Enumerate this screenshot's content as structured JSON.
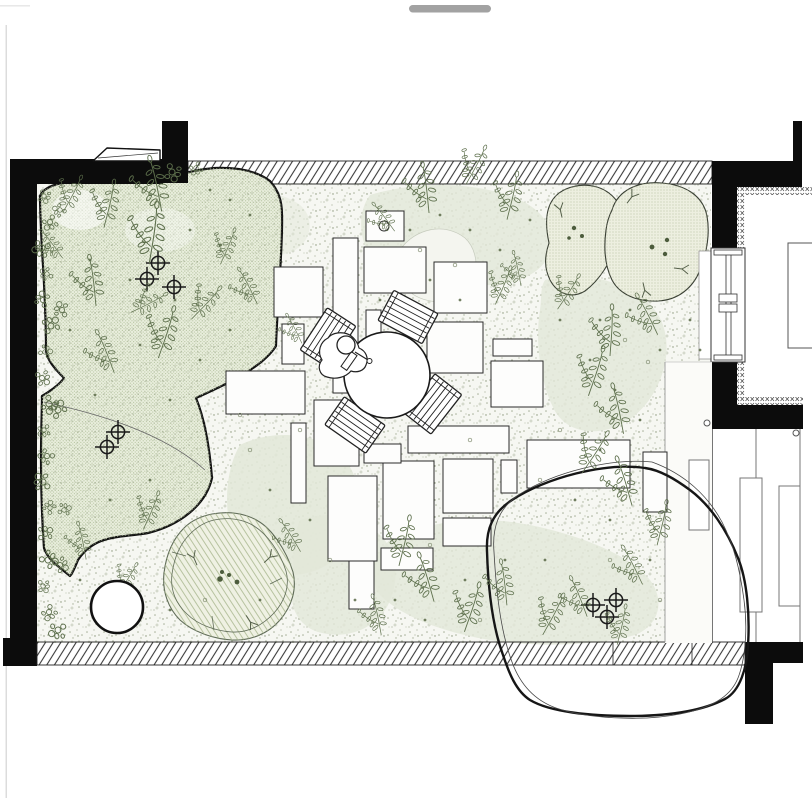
{
  "canvas": {
    "width": 812,
    "height": 800,
    "background": "#ffffff"
  },
  "ui": {
    "drag_handle": {
      "color": "#a2a2a2"
    }
  },
  "palette": {
    "ink": "#1a1a1a",
    "wall_black": "#0c0c0c",
    "line_gray": "#555555",
    "foliage_green": "#5d6f4c",
    "twig_green": "#55604a",
    "bed_base": "#e9eedd",
    "bed_dot": "#b0bf99",
    "mound_base": "#edefe0",
    "mound_dot": "#a8b192",
    "groundcover_base": "#eff1e3",
    "groundcover_line": "#a9b78f",
    "wash_green": "#e2e7d8",
    "stipple": "#97a287",
    "marker_dot": "#4c5c3c"
  },
  "plan": {
    "paving_stones": [
      [
        366,
        211,
        38,
        30,
        1
      ],
      [
        333,
        238,
        25,
        155,
        0
      ],
      [
        364,
        247,
        62,
        46,
        0
      ],
      [
        434,
        262,
        53,
        51,
        0
      ],
      [
        274,
        267,
        49,
        50,
        0
      ],
      [
        282,
        324,
        22,
        40,
        0
      ],
      [
        366,
        310,
        15,
        84,
        0
      ],
      [
        427,
        322,
        56,
        51,
        0
      ],
      [
        493,
        339,
        39,
        17,
        0
      ],
      [
        491,
        361,
        52,
        46,
        0
      ],
      [
        226,
        371,
        79,
        43,
        0
      ],
      [
        314,
        400,
        45,
        66,
        0
      ],
      [
        291,
        423,
        15,
        80,
        0
      ],
      [
        408,
        426,
        101,
        27,
        0
      ],
      [
        383,
        461,
        51,
        78,
        0
      ],
      [
        443,
        459,
        50,
        54,
        0
      ],
      [
        501,
        460,
        16,
        33,
        0
      ],
      [
        443,
        518,
        48,
        28,
        0
      ],
      [
        328,
        476,
        49,
        85,
        0
      ],
      [
        349,
        561,
        25,
        48,
        0
      ],
      [
        381,
        548,
        52,
        22,
        0
      ],
      [
        527,
        440,
        103,
        48,
        0
      ],
      [
        643,
        452,
        24,
        60,
        0
      ],
      [
        364,
        444,
        37,
        19,
        0
      ]
    ],
    "deck_furniture": [
      [
        689,
        460,
        20,
        70
      ],
      [
        740,
        478,
        22,
        134
      ],
      [
        779,
        486,
        21,
        120
      ]
    ],
    "room_table": [
      788,
      243,
      26,
      105
    ],
    "tree_markers": [
      [
        158,
        263
      ],
      [
        147,
        279
      ],
      [
        174,
        287
      ],
      [
        118,
        432
      ],
      [
        107,
        447
      ],
      [
        593,
        605
      ],
      [
        616,
        600
      ],
      [
        607,
        617
      ]
    ],
    "mound_dots": [
      [
        574,
        228,
        2.2
      ],
      [
        582,
        236,
        2.0
      ],
      [
        569,
        238,
        1.8
      ],
      [
        652,
        247,
        2.4
      ],
      [
        667,
        240,
        2.2
      ],
      [
        665,
        254,
        2.2
      ],
      [
        222,
        572,
        2.0
      ],
      [
        220,
        579,
        2.8
      ],
      [
        229,
        575,
        2.0
      ],
      [
        237,
        582,
        2.4
      ]
    ],
    "twigs": [
      [
        560,
        212,
        -20
      ],
      [
        630,
        198,
        30
      ],
      [
        645,
        288,
        160
      ],
      [
        680,
        268,
        90
      ],
      [
        194,
        560,
        -30
      ],
      [
        250,
        620,
        140
      ],
      [
        268,
        558,
        40
      ]
    ],
    "ferns": [
      [
        160,
        205,
        -15,
        1.1
      ],
      [
        105,
        222,
        10,
        0.95
      ],
      [
        65,
        208,
        25,
        0.8
      ],
      [
        150,
        256,
        5,
        1.2
      ],
      [
        95,
        300,
        -10,
        1.0
      ],
      [
        160,
        352,
        15,
        1.05
      ],
      [
        112,
        368,
        -25,
        0.9
      ],
      [
        195,
        315,
        40,
        0.85
      ],
      [
        255,
        300,
        -30,
        0.8
      ],
      [
        222,
        260,
        20,
        0.75
      ],
      [
        60,
        255,
        -40,
        0.7
      ],
      [
        135,
        310,
        60,
        0.8
      ],
      [
        428,
        207,
        -10,
        1.0
      ],
      [
        468,
        180,
        25,
        0.85
      ],
      [
        508,
        214,
        10,
        0.95
      ],
      [
        392,
        228,
        -40,
        0.7
      ],
      [
        300,
        340,
        -30,
        0.65
      ],
      [
        497,
        300,
        20,
        0.8
      ],
      [
        520,
        282,
        -15,
        0.7
      ],
      [
        560,
        305,
        30,
        0.8
      ],
      [
        610,
        350,
        0,
        1.0
      ],
      [
        655,
        330,
        -30,
        0.9
      ],
      [
        590,
        390,
        15,
        1.0
      ],
      [
        622,
        428,
        -15,
        1.0
      ],
      [
        585,
        468,
        30,
        0.95
      ],
      [
        630,
        500,
        -20,
        1.0
      ],
      [
        658,
        540,
        10,
        0.9
      ],
      [
        640,
        580,
        -30,
        0.85
      ],
      [
        400,
        560,
        10,
        1.0
      ],
      [
        432,
        596,
        -20,
        1.0
      ],
      [
        466,
        626,
        15,
        1.0
      ],
      [
        506,
        600,
        -10,
        0.9
      ],
      [
        545,
        630,
        25,
        0.9
      ],
      [
        585,
        612,
        -25,
        0.85
      ],
      [
        618,
        640,
        10,
        0.8
      ],
      [
        380,
        630,
        -15,
        0.8
      ],
      [
        145,
        525,
        20,
        0.8
      ],
      [
        85,
        555,
        -15,
        0.75
      ],
      [
        298,
        548,
        -35,
        0.75
      ],
      [
        120,
        590,
        30,
        0.7
      ]
    ],
    "leaf_clusters": [
      [
        44,
        196
      ],
      [
        50,
        222
      ],
      [
        42,
        248
      ],
      [
        47,
        274
      ],
      [
        43,
        300
      ],
      [
        51,
        326
      ],
      [
        45,
        352
      ],
      [
        42,
        378
      ],
      [
        49,
        404
      ],
      [
        44,
        430
      ],
      [
        47,
        456
      ],
      [
        43,
        482
      ],
      [
        50,
        508
      ],
      [
        45,
        534
      ],
      [
        48,
        560
      ],
      [
        43,
        586
      ],
      [
        49,
        612
      ],
      [
        58,
        630
      ],
      [
        60,
        210
      ],
      [
        62,
        310
      ],
      [
        58,
        410
      ],
      [
        64,
        510
      ],
      [
        60,
        565
      ],
      [
        172,
        172
      ],
      [
        196,
        168
      ]
    ],
    "scatter_dots": [
      [
        210,
        190
      ],
      [
        230,
        200
      ],
      [
        250,
        215
      ],
      [
        190,
        230
      ],
      [
        220,
        245
      ],
      [
        175,
        300
      ],
      [
        130,
        280
      ],
      [
        90,
        260
      ],
      [
        70,
        330
      ],
      [
        140,
        345
      ],
      [
        200,
        360
      ],
      [
        230,
        330
      ],
      [
        95,
        395
      ],
      [
        170,
        400
      ],
      [
        410,
        230
      ],
      [
        440,
        215
      ],
      [
        470,
        230
      ],
      [
        500,
        250
      ],
      [
        530,
        220
      ],
      [
        430,
        280
      ],
      [
        460,
        300
      ],
      [
        380,
        300
      ],
      [
        560,
        320
      ],
      [
        600,
        320
      ],
      [
        630,
        310
      ],
      [
        660,
        350
      ],
      [
        590,
        360
      ],
      [
        615,
        390
      ],
      [
        640,
        420
      ],
      [
        600,
        450
      ],
      [
        575,
        500
      ],
      [
        610,
        520
      ],
      [
        650,
        560
      ],
      [
        545,
        560
      ],
      [
        505,
        560
      ],
      [
        465,
        580
      ],
      [
        425,
        620
      ],
      [
        395,
        600
      ],
      [
        355,
        600
      ],
      [
        310,
        520
      ],
      [
        270,
        490
      ],
      [
        150,
        480
      ],
      [
        110,
        500
      ],
      [
        80,
        580
      ],
      [
        170,
        610
      ],
      [
        260,
        600
      ],
      [
        690,
        320
      ],
      [
        700,
        350
      ]
    ],
    "rings": [
      [
        300,
        430
      ],
      [
        420,
        250
      ],
      [
        455,
        265
      ],
      [
        560,
        430
      ],
      [
        610,
        560
      ],
      [
        430,
        545
      ],
      [
        250,
        450
      ],
      [
        480,
        620
      ],
      [
        330,
        560
      ],
      [
        660,
        600
      ],
      [
        540,
        480
      ],
      [
        470,
        440
      ],
      [
        240,
        415
      ],
      [
        205,
        600
      ],
      [
        625,
        340
      ],
      [
        648,
        362
      ]
    ],
    "table": {
      "cx": 387,
      "cy": 375,
      "r": 43
    },
    "chairs": [
      [
        408,
        317,
        28
      ],
      [
        433,
        404,
        -52
      ],
      [
        355,
        425,
        35
      ],
      [
        328,
        338,
        -57
      ]
    ],
    "door_pivots": [
      [
        707,
        423
      ],
      [
        796,
        433
      ]
    ]
  }
}
